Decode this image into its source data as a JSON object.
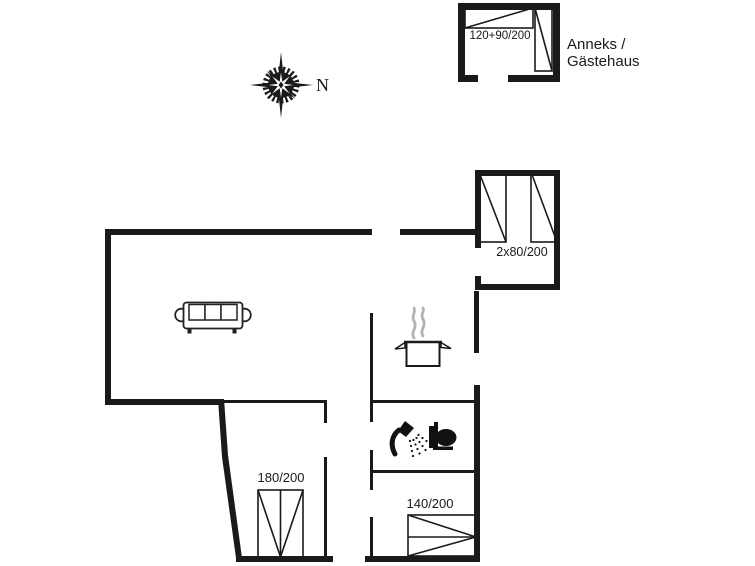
{
  "compass": {
    "north_label": "N"
  },
  "annex": {
    "name_line1": "Anneks /",
    "name_line2": "Gästehaus",
    "bed_size_label": "120+90/200"
  },
  "main_house": {
    "twin_bedroom": {
      "bed_size_label": "2x80/200"
    },
    "double_bedroom": {
      "bed_size_label": "180/200"
    },
    "small_double_bedroom": {
      "bed_size_label": "140/200"
    }
  },
  "icons": {
    "compass_rose": "compass-rose-icon",
    "sofa": "sofa-icon",
    "cooking_pot": "cooking-pot-icon",
    "shower": "shower-icon",
    "toilet": "toilet-icon"
  },
  "colors": {
    "wall": "#1a1a1a",
    "line": "#222222",
    "steam": "#b3b3b3",
    "background": "#ffffff"
  }
}
